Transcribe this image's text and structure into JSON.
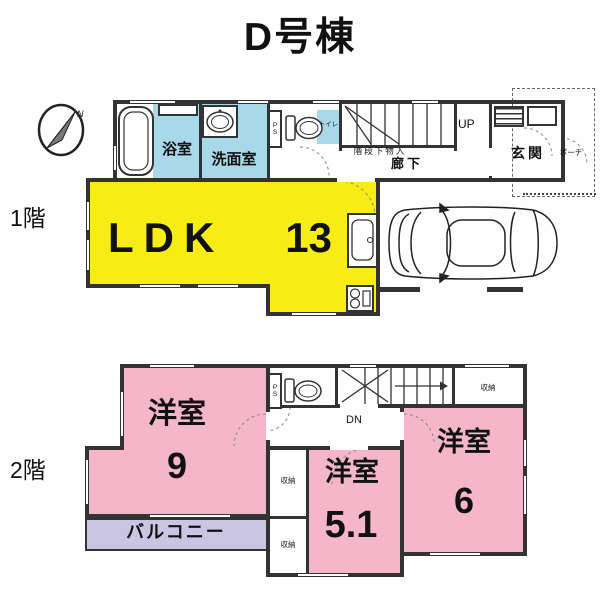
{
  "title": "D号棟",
  "compass": {
    "north": "N"
  },
  "floor1": {
    "label": "1階",
    "bath": "浴室",
    "washroom": "洗面室",
    "toilet": "トイレ",
    "ps": "PS",
    "up": "UP",
    "under_stairs": "階段下物入",
    "hallway": "廊下",
    "entrance": "玄関",
    "porch": "ポーチ",
    "ldk_name": "LDK",
    "ldk_size": "13"
  },
  "floor2": {
    "label": "2階",
    "room9_name": "洋室",
    "room9_size": "9",
    "room51_name": "洋室",
    "room51_size": "5.1",
    "room6_name": "洋室",
    "room6_size": "6",
    "balcony": "バルコニー",
    "closet": "収納",
    "ps": "PS",
    "dn": "DN"
  },
  "colors": {
    "ldk_yellow": "#f8ec15",
    "wet_cyan": "#a9d9e9",
    "room_pink": "#f6b6c9",
    "balcony_lavender": "#c9c5e3",
    "wall": "#333333"
  }
}
